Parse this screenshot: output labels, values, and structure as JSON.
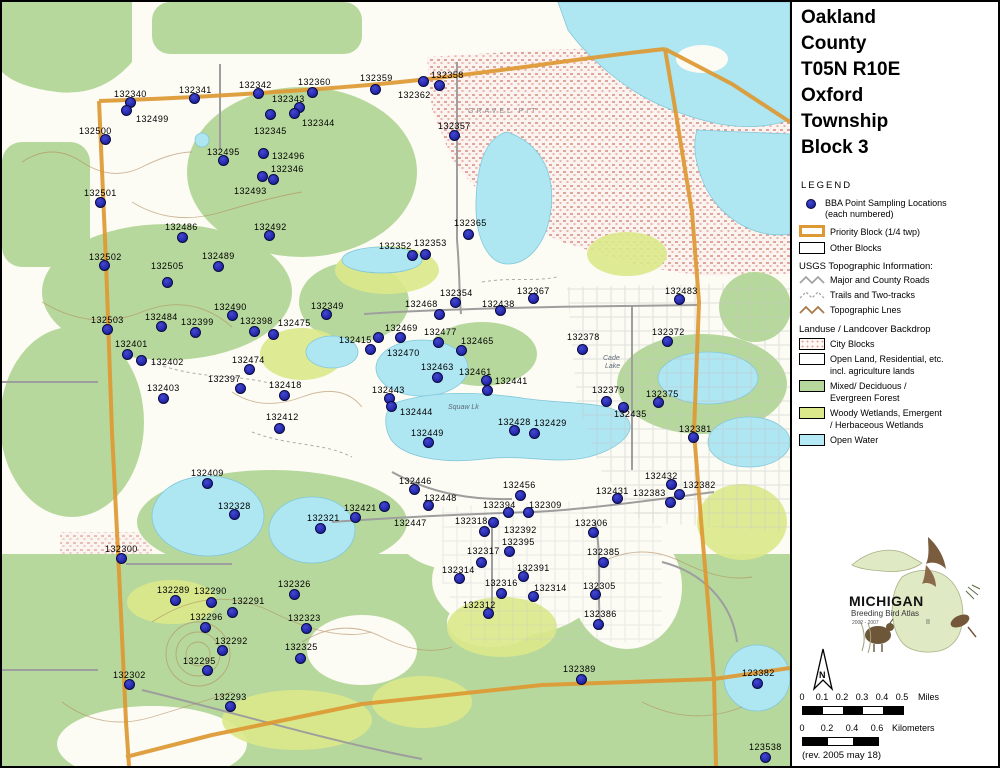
{
  "title": {
    "lines": [
      "Oakland",
      "County",
      "T05N R10E",
      "Oxford",
      "Township",
      "Block 3"
    ]
  },
  "legend": {
    "heading": "LEGEND",
    "bba_label": "BBA Point Sampling Locations",
    "bba_sub": "(each numbered)",
    "priority_label": "Priority Block (1/4 twp)",
    "other_label": "Other Blocks",
    "usgs_heading": "USGS Topographic Information:",
    "usgs_items": [
      "Major and County Roads",
      "Trails and Two-tracks",
      "Topographic Lnes"
    ],
    "landuse_heading": "Landuse / Landcover Backdrop",
    "landuse_items": [
      {
        "swatch": "city",
        "l1": "City Blocks",
        "l2": ""
      },
      {
        "swatch": "open",
        "l1": "Open Land, Residential, etc.",
        "l2": "incl. agriculture lands"
      },
      {
        "swatch": "forest",
        "l1": "Mixed/ Deciduous /",
        "l2": "Evergreen Forest"
      },
      {
        "swatch": "wetland",
        "l1": "Woody Wetlands, Emergent",
        "l2": "/ Herbaceous Wetlands"
      },
      {
        "swatch": "water",
        "l1": "Open Water",
        "l2": ""
      }
    ]
  },
  "logo": {
    "title": "MICHIGAN",
    "subtitle": "Breeding Bird Atlas",
    "years": "2002 - 2007",
    "numeral": "II"
  },
  "north": {
    "label": "N"
  },
  "scales": {
    "miles": {
      "ticks": [
        "0",
        "0.1",
        "0.2",
        "0.3",
        "0.4",
        "0.5"
      ],
      "unit": "Miles"
    },
    "km": {
      "ticks": [
        "0",
        "0.2",
        "0.4",
        "0.6"
      ],
      "unit": "Kilometers"
    }
  },
  "revision": "(rev. 2005 may 18)",
  "colors": {
    "dot_fill": "#272cb2",
    "dot_stroke": "#0a0a40",
    "priority_orange": "#dd9933",
    "forest_green": "#b7d89c",
    "wetland_green": "#dce98a",
    "open_water": "#aee6f2",
    "city_pink": "#dfa49a",
    "road_gray": "#9e9e9e",
    "contour_brown": "#b08a5c"
  },
  "map": {
    "texts": [
      {
        "t": "GRAVEL PIT",
        "x": 466,
        "y": 106,
        "style": "spread"
      },
      {
        "t": "Squaw Lk",
        "x": 446,
        "y": 402,
        "style": ""
      },
      {
        "t": "Cade",
        "x": 601,
        "y": 353,
        "style": ""
      },
      {
        "t": "Lake",
        "x": 603,
        "y": 361,
        "style": ""
      }
    ],
    "points": [
      {
        "id": "132340",
        "lx": 112,
        "ly": 88,
        "dx": 129,
        "dy": 101
      },
      {
        "id": "132499",
        "lx": 134,
        "ly": 113,
        "dx": 125,
        "dy": 109
      },
      {
        "id": "132341",
        "lx": 177,
        "ly": 84,
        "dx": 193,
        "dy": 97
      },
      {
        "id": "132342",
        "lx": 237,
        "ly": 79,
        "dx": 257,
        "dy": 92
      },
      {
        "id": "132360",
        "lx": 296,
        "ly": 76,
        "dx": 311,
        "dy": 91
      },
      {
        "id": "132359",
        "lx": 358,
        "ly": 72,
        "dx": 374,
        "dy": 88
      },
      {
        "id": "132358",
        "lx": 429,
        "ly": 69,
        "dx": 438,
        "dy": 84
      },
      {
        "id": "132362",
        "lx": 396,
        "ly": 89,
        "dx": 422,
        "dy": 80
      },
      {
        "id": "132343",
        "lx": 270,
        "ly": 93,
        "dx": 298,
        "dy": 106
      },
      {
        "id": "132344",
        "lx": 300,
        "ly": 117,
        "dx": 293,
        "dy": 112
      },
      {
        "id": "132345",
        "lx": 252,
        "ly": 125,
        "dx": 269,
        "dy": 113
      },
      {
        "id": "132357",
        "lx": 436,
        "ly": 120,
        "dx": 453,
        "dy": 134
      },
      {
        "id": "132500",
        "lx": 77,
        "ly": 125,
        "dx": 104,
        "dy": 138
      },
      {
        "id": "132495",
        "lx": 205,
        "ly": 146,
        "dx": 222,
        "dy": 159
      },
      {
        "id": "132496",
        "lx": 270,
        "ly": 150,
        "dx": 262,
        "dy": 152
      },
      {
        "id": "132346",
        "lx": 269,
        "ly": 163,
        "dx": 261,
        "dy": 175
      },
      {
        "id": "132493",
        "lx": 232,
        "ly": 185,
        "dx": 272,
        "dy": 178
      },
      {
        "id": "132501",
        "lx": 82,
        "ly": 187,
        "dx": 99,
        "dy": 201
      },
      {
        "id": "132486",
        "lx": 163,
        "ly": 221,
        "dx": 181,
        "dy": 236
      },
      {
        "id": "132492",
        "lx": 252,
        "ly": 221,
        "dx": 268,
        "dy": 234
      },
      {
        "id": "132365",
        "lx": 452,
        "ly": 217,
        "dx": 467,
        "dy": 233
      },
      {
        "id": "132502",
        "lx": 87,
        "ly": 251,
        "dx": 103,
        "dy": 264
      },
      {
        "id": "132505",
        "lx": 149,
        "ly": 260,
        "dx": 166,
        "dy": 281
      },
      {
        "id": "132489",
        "lx": 200,
        "ly": 250,
        "dx": 217,
        "dy": 265
      },
      {
        "id": "132352",
        "lx": 377,
        "ly": 240,
        "dx": 411,
        "dy": 254
      },
      {
        "id": "132353",
        "lx": 412,
        "ly": 237,
        "dx": 424,
        "dy": 253
      },
      {
        "id": "132490",
        "lx": 212,
        "ly": 301,
        "dx": 231,
        "dy": 314
      },
      {
        "id": "132349",
        "lx": 309,
        "ly": 300,
        "dx": 325,
        "dy": 313
      },
      {
        "id": "132354",
        "lx": 438,
        "ly": 287,
        "dx": 454,
        "dy": 301
      },
      {
        "id": "132367",
        "lx": 515,
        "ly": 285,
        "dx": 532,
        "dy": 297
      },
      {
        "id": "132468",
        "lx": 403,
        "ly": 298,
        "dx": 438,
        "dy": 313
      },
      {
        "id": "132438",
        "lx": 480,
        "ly": 298,
        "dx": 499,
        "dy": 309
      },
      {
        "id": "132483",
        "lx": 663,
        "ly": 285,
        "dx": 678,
        "dy": 298
      },
      {
        "id": "132503",
        "lx": 89,
        "ly": 314,
        "dx": 106,
        "dy": 328
      },
      {
        "id": "132484",
        "lx": 143,
        "ly": 311,
        "dx": 160,
        "dy": 325
      },
      {
        "id": "132399",
        "lx": 179,
        "ly": 316,
        "dx": 194,
        "dy": 331
      },
      {
        "id": "132398",
        "lx": 238,
        "ly": 315,
        "dx": 253,
        "dy": 330
      },
      {
        "id": "132475",
        "lx": 276,
        "ly": 317,
        "dx": 272,
        "dy": 333
      },
      {
        "id": "132372",
        "lx": 650,
        "ly": 326,
        "dx": 666,
        "dy": 340
      },
      {
        "id": "132415",
        "lx": 337,
        "ly": 334,
        "dx": 377,
        "dy": 336
      },
      {
        "id": "132469",
        "lx": 383,
        "ly": 322,
        "dx": 399,
        "dy": 336
      },
      {
        "id": "132477",
        "lx": 422,
        "ly": 326,
        "dx": 437,
        "dy": 341
      },
      {
        "id": "132470",
        "lx": 385,
        "ly": 347,
        "dx": 369,
        "dy": 348
      },
      {
        "id": "132465",
        "lx": 459,
        "ly": 335,
        "dx": 460,
        "dy": 349
      },
      {
        "id": "132401",
        "lx": 113,
        "ly": 338,
        "dx": 126,
        "dy": 353
      },
      {
        "id": "132402",
        "lx": 149,
        "ly": 356,
        "dx": 140,
        "dy": 359
      },
      {
        "id": "132474",
        "lx": 230,
        "ly": 354,
        "dx": 248,
        "dy": 368
      },
      {
        "id": "132397",
        "lx": 206,
        "ly": 373,
        "dx": 239,
        "dy": 387
      },
      {
        "id": "132418",
        "lx": 267,
        "ly": 379,
        "dx": 283,
        "dy": 394
      },
      {
        "id": "132403",
        "lx": 145,
        "ly": 382,
        "dx": 162,
        "dy": 397
      },
      {
        "id": "132463",
        "lx": 419,
        "ly": 361,
        "dx": 436,
        "dy": 376
      },
      {
        "id": "132461",
        "lx": 457,
        "ly": 366,
        "dx": 485,
        "dy": 379
      },
      {
        "id": "132441",
        "lx": 493,
        "ly": 375,
        "dx": 486,
        "dy": 389
      },
      {
        "id": "132378",
        "lx": 565,
        "ly": 331,
        "dx": 581,
        "dy": 348
      },
      {
        "id": "132443",
        "lx": 370,
        "ly": 384,
        "dx": 388,
        "dy": 397
      },
      {
        "id": "132444",
        "lx": 398,
        "ly": 406,
        "dx": 390,
        "dy": 405
      },
      {
        "id": "132412",
        "lx": 264,
        "ly": 411,
        "dx": 278,
        "dy": 427
      },
      {
        "id": "132379",
        "lx": 590,
        "ly": 384,
        "dx": 605,
        "dy": 400
      },
      {
        "id": "132375",
        "lx": 644,
        "ly": 388,
        "dx": 657,
        "dy": 401
      },
      {
        "id": "132435",
        "lx": 612,
        "ly": 408,
        "dx": 622,
        "dy": 406
      },
      {
        "id": "132428",
        "lx": 496,
        "ly": 416,
        "dx": 513,
        "dy": 429
      },
      {
        "id": "132429",
        "lx": 532,
        "ly": 417,
        "dx": 533,
        "dy": 432
      },
      {
        "id": "132449",
        "lx": 409,
        "ly": 427,
        "dx": 427,
        "dy": 441
      },
      {
        "id": "132381",
        "lx": 677,
        "ly": 423,
        "dx": 692,
        "dy": 436
      },
      {
        "id": "132409",
        "lx": 189,
        "ly": 467,
        "dx": 206,
        "dy": 482
      },
      {
        "id": "132328",
        "lx": 216,
        "ly": 500,
        "dx": 233,
        "dy": 513
      },
      {
        "id": "132446",
        "lx": 397,
        "ly": 475,
        "dx": 413,
        "dy": 488
      },
      {
        "id": "132448",
        "lx": 422,
        "ly": 492,
        "dx": 427,
        "dy": 504
      },
      {
        "id": "132456",
        "lx": 501,
        "ly": 479,
        "dx": 519,
        "dy": 494
      },
      {
        "id": "132432",
        "lx": 643,
        "ly": 470,
        "dx": 670,
        "dy": 483
      },
      {
        "id": "132431",
        "lx": 594,
        "ly": 485,
        "dx": 616,
        "dy": 497
      },
      {
        "id": "132383",
        "lx": 631,
        "ly": 487,
        "dx": 669,
        "dy": 501
      },
      {
        "id": "132382",
        "lx": 681,
        "ly": 479,
        "dx": 678,
        "dy": 493
      },
      {
        "id": "132421",
        "lx": 342,
        "ly": 502,
        "dx": 354,
        "dy": 516
      },
      {
        "id": "132447",
        "lx": 392,
        "ly": 517,
        "dx": 383,
        "dy": 505
      },
      {
        "id": "132321",
        "lx": 305,
        "ly": 512,
        "dx": 319,
        "dy": 527
      },
      {
        "id": "132300",
        "lx": 103,
        "ly": 543,
        "dx": 120,
        "dy": 557
      },
      {
        "id": "132394",
        "lx": 481,
        "ly": 499,
        "dx": 507,
        "dy": 511
      },
      {
        "id": "132309",
        "lx": 527,
        "ly": 499,
        "dx": 527,
        "dy": 511
      },
      {
        "id": "132318",
        "lx": 453,
        "ly": 515,
        "dx": 492,
        "dy": 521
      },
      {
        "id": "132392",
        "lx": 502,
        "ly": 524,
        "dx": 483,
        "dy": 530
      },
      {
        "id": "132395",
        "lx": 500,
        "ly": 536,
        "dx": 508,
        "dy": 550
      },
      {
        "id": "132317",
        "lx": 465,
        "ly": 545,
        "dx": 480,
        "dy": 561
      },
      {
        "id": "132391",
        "lx": 515,
        "ly": 562,
        "dx": 522,
        "dy": 575
      },
      {
        "id": "132314",
        "lx": 440,
        "ly": 564,
        "dx": 458,
        "dy": 577
      },
      {
        "id": "132316",
        "lx": 483,
        "ly": 577,
        "dx": 500,
        "dy": 592
      },
      {
        "id": "132314",
        "lx": 532,
        "ly": 582,
        "dx": 532,
        "dy": 595
      },
      {
        "id": "132312",
        "lx": 461,
        "ly": 599,
        "dx": 487,
        "dy": 612
      },
      {
        "id": "132306",
        "lx": 573,
        "ly": 517,
        "dx": 592,
        "dy": 531
      },
      {
        "id": "132385",
        "lx": 585,
        "ly": 546,
        "dx": 602,
        "dy": 561
      },
      {
        "id": "132305",
        "lx": 581,
        "ly": 580,
        "dx": 594,
        "dy": 593
      },
      {
        "id": "132386",
        "lx": 582,
        "ly": 608,
        "dx": 597,
        "dy": 623
      },
      {
        "id": "132289",
        "lx": 155,
        "ly": 584,
        "dx": 174,
        "dy": 599
      },
      {
        "id": "132290",
        "lx": 192,
        "ly": 585,
        "dx": 210,
        "dy": 601
      },
      {
        "id": "132291",
        "lx": 230,
        "ly": 595,
        "dx": 231,
        "dy": 611
      },
      {
        "id": "132296",
        "lx": 188,
        "ly": 611,
        "dx": 204,
        "dy": 626
      },
      {
        "id": "132326",
        "lx": 276,
        "ly": 578,
        "dx": 293,
        "dy": 593
      },
      {
        "id": "132323",
        "lx": 286,
        "ly": 612,
        "dx": 305,
        "dy": 627
      },
      {
        "id": "132292",
        "lx": 213,
        "ly": 635,
        "dx": 221,
        "dy": 649
      },
      {
        "id": "132325",
        "lx": 283,
        "ly": 641,
        "dx": 299,
        "dy": 657
      },
      {
        "id": "132295",
        "lx": 181,
        "ly": 655,
        "dx": 206,
        "dy": 669
      },
      {
        "id": "132302",
        "lx": 111,
        "ly": 669,
        "dx": 128,
        "dy": 683
      },
      {
        "id": "132293",
        "lx": 212,
        "ly": 691,
        "dx": 229,
        "dy": 705
      },
      {
        "id": "132389",
        "lx": 561,
        "ly": 663,
        "dx": 580,
        "dy": 678
      },
      {
        "id": "123382",
        "lx": 740,
        "ly": 667,
        "dx": 756,
        "dy": 682
      },
      {
        "id": "123538",
        "lx": 747,
        "ly": 741,
        "dx": 764,
        "dy": 756
      }
    ]
  }
}
